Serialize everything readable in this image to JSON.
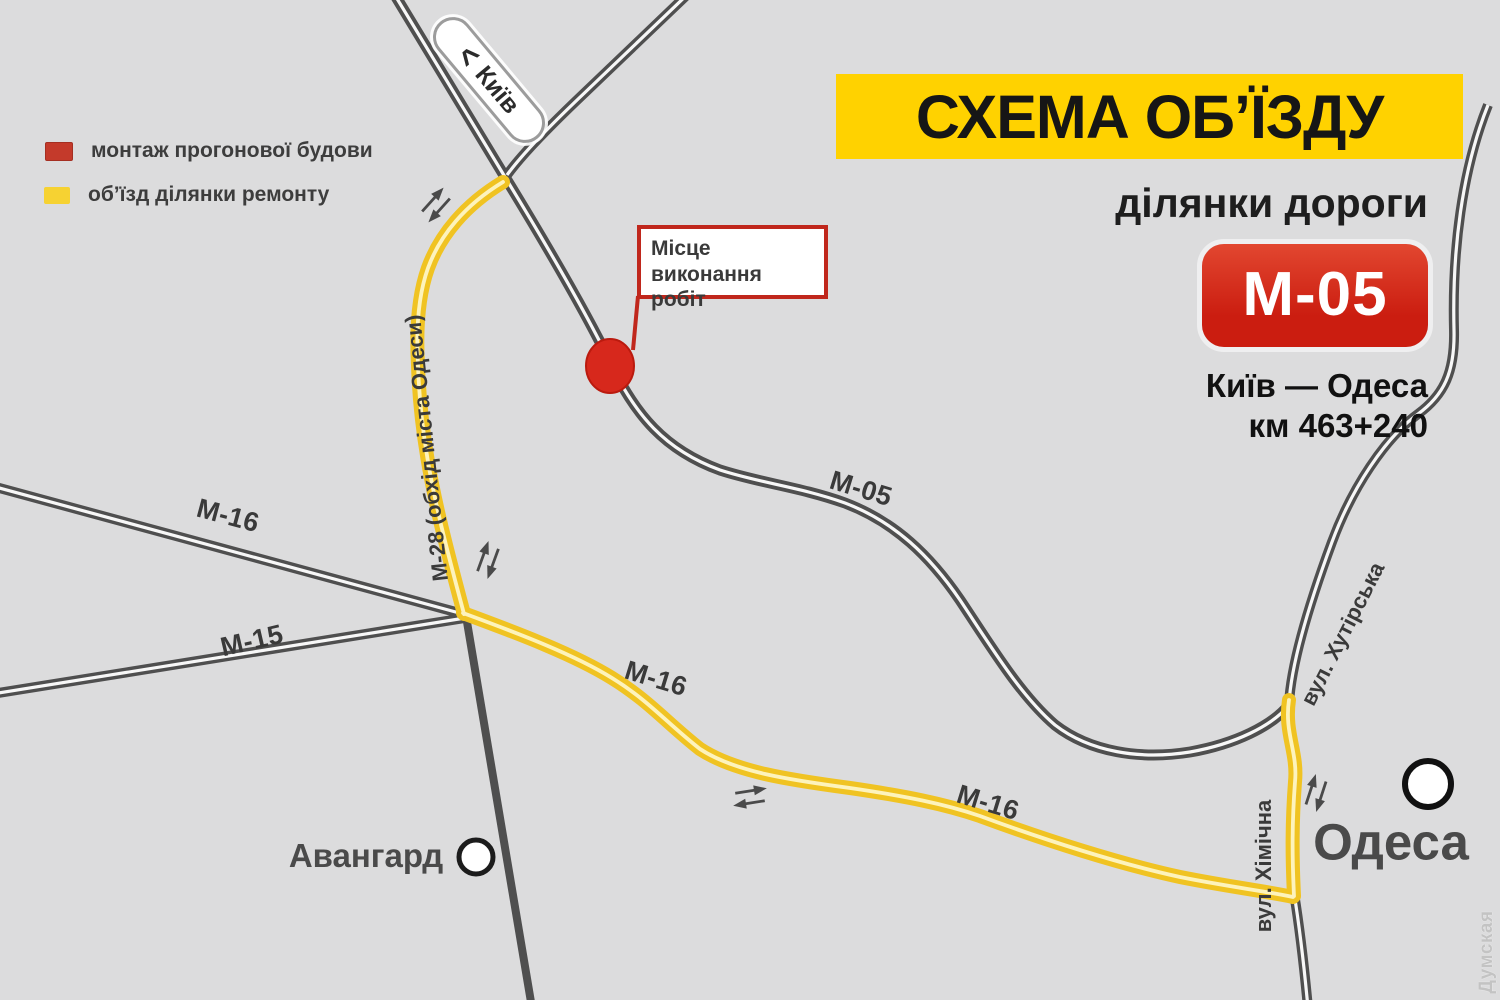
{
  "legend": {
    "items": [
      {
        "swatch_color": "#c43a2b",
        "label": "монтаж прогонової будови"
      },
      {
        "swatch_color": "#f6d232",
        "label": "об’їзд ділянки ремонту"
      }
    ]
  },
  "header": {
    "title": "СХЕМА ОБ’ЇЗДУ",
    "subtitle": "ділянки дороги",
    "badge": "М-05",
    "route": "Київ — Одеса",
    "kilometer": "км 463+240"
  },
  "signs": {
    "kyiv_arrow": "<",
    "kyiv": "Київ"
  },
  "callout": {
    "line1": "Місце",
    "line2": "виконання робіт"
  },
  "roads": {
    "m05": "М-05",
    "m16_west": "М-16",
    "m15": "М-15",
    "m28_bypass": "М-28 (обхід міста Одеси)",
    "m16_detour_a": "М-16",
    "m16_detour_b": "М-16",
    "khutirska_st": "вул. Хутірська",
    "khimichna_st": "вул. Хімічна"
  },
  "places": {
    "avangard": "Авангард",
    "odesa": "Одеса"
  },
  "watermark": "Думская",
  "colors": {
    "background": "#dcdcdd",
    "road_gray": "#4f4f4f",
    "road_casing": "#f7f7f7",
    "detour_yellow": "#f0c322",
    "detour_center": "#fdf3bc",
    "accent_red": "#c9271a",
    "banner_yellow": "#ffd200",
    "badge_red": "#cf2114"
  }
}
